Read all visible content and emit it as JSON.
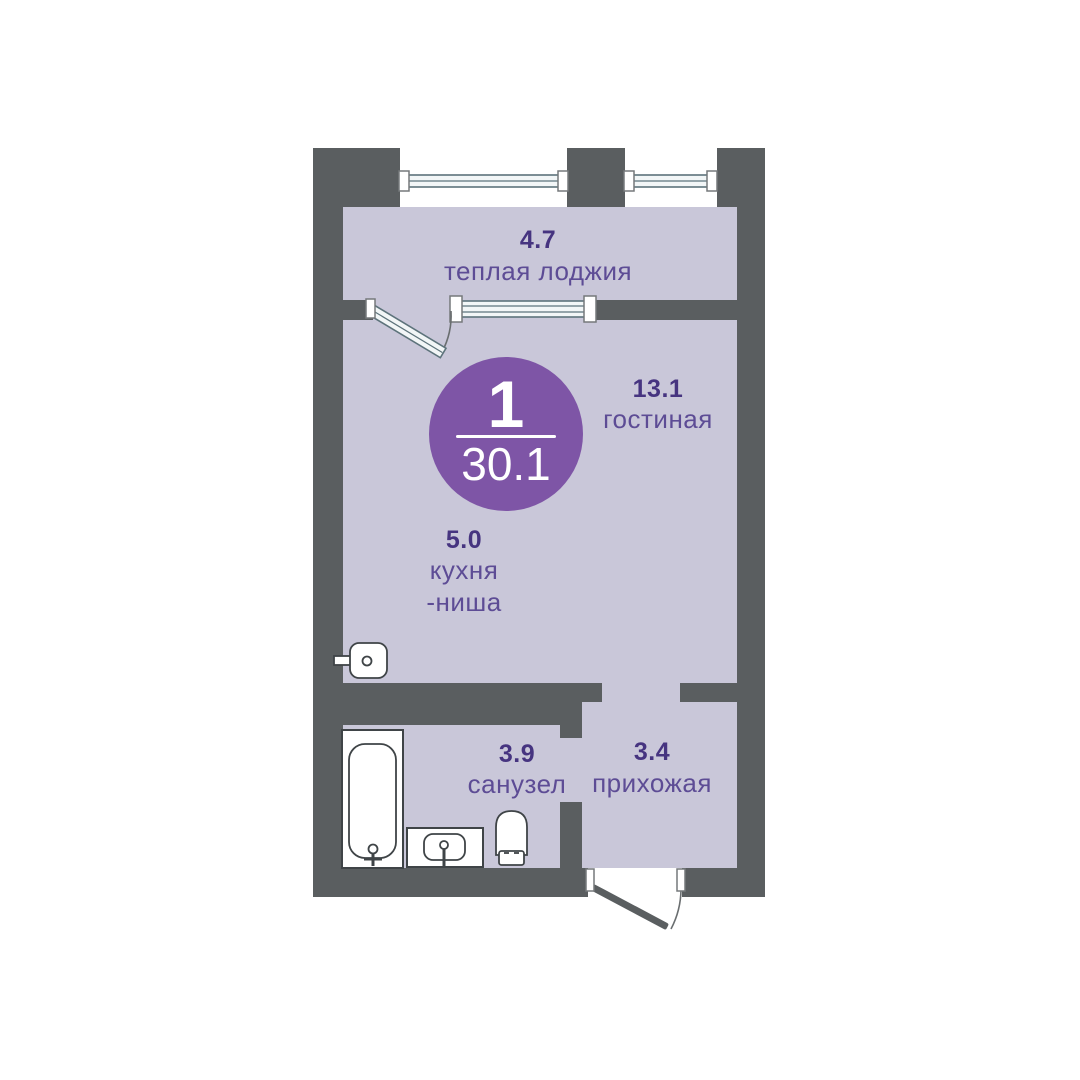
{
  "badge": {
    "rooms_count": "1",
    "total_area": "30.1"
  },
  "rooms": [
    {
      "area": "4.7",
      "name": "теплая лоджия"
    },
    {
      "area": "13.1",
      "name": "гостиная"
    },
    {
      "area": "5.0",
      "name": "кухня",
      "name_line2": "-ниша"
    },
    {
      "area": "3.9",
      "name": "санузел"
    },
    {
      "area": "3.4",
      "name": "прихожая"
    }
  ],
  "icons": {
    "window": "window-icon",
    "balcony_door": "balcony-door-icon",
    "entrance_door": "entrance-door-icon",
    "bathtub": "bathtub-icon",
    "sink": "sink-icon",
    "toilet": "toilet-icon",
    "appliance": "appliance-icon"
  },
  "colors": {
    "wall": "#5a5e60",
    "floor": "#c9c7d9",
    "badge": "#7e55a6",
    "badge_text": "#ffffff",
    "area_text": "#463480",
    "name_text": "#5d4c95",
    "window_stroke": "#5d737b",
    "window_fill": "#f2f6f7",
    "fixture_stroke": "#3f4447"
  }
}
